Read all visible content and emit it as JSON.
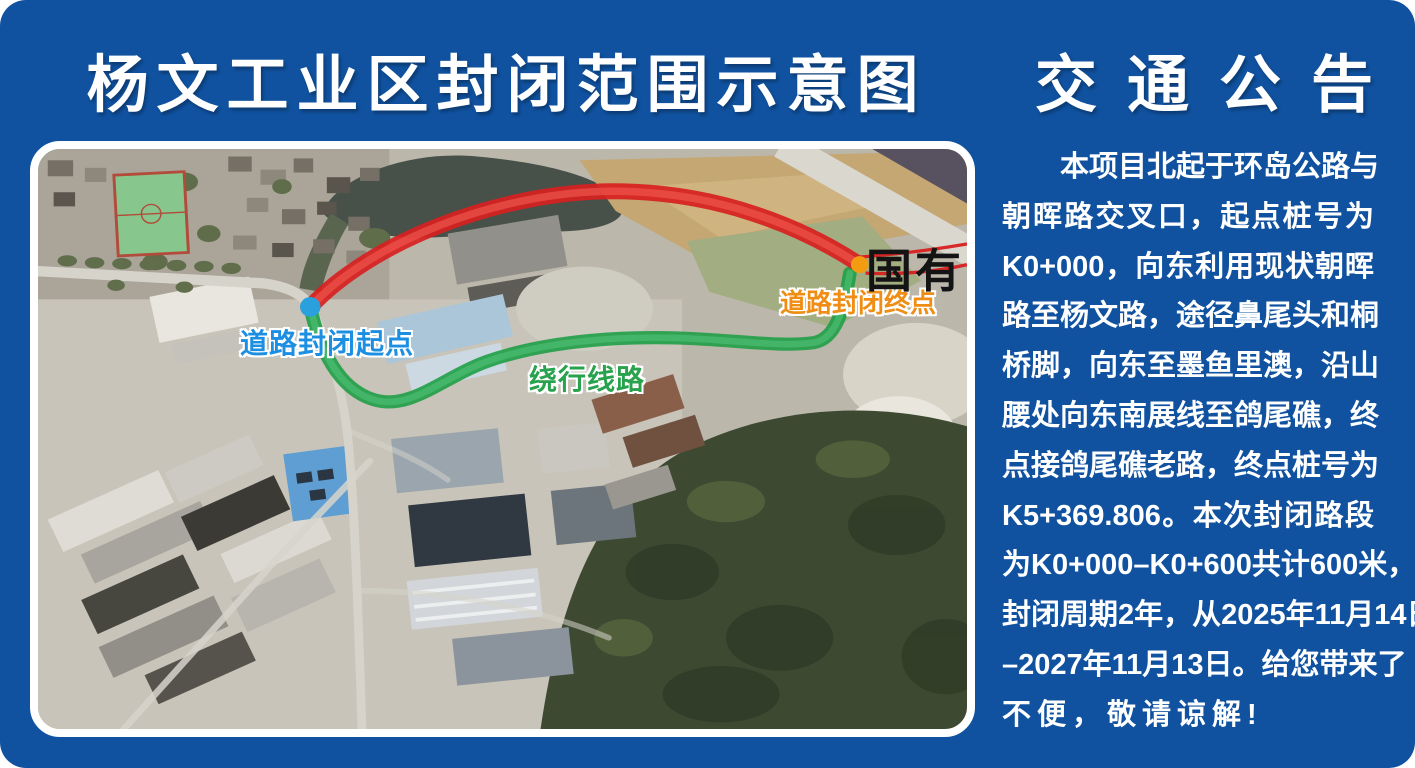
{
  "poster": {
    "bg_color": "#1052a0",
    "map_title": "杨文工业区封闭范围示意图",
    "notice_title": "交通公告"
  },
  "notice_lines": [
    "本项目北起于环岛公路与",
    "朝晖路交叉口，起点桩号为",
    "K0+000，向东利用现状朝晖",
    "路至杨文路，途径鼻尾头和桐",
    "桥脚，向东至墨鱼里澳，沿山",
    "腰处向东南展线至鸽尾礁，终",
    "点接鸽尾礁老路，终点桩号为",
    "K5+369.806。本次封闭路段",
    "为K0+000–K0+600共计600米，",
    "封闭周期2年，从2025年11月14日",
    "–2027年11月13日。给您带来了",
    "不便，敬请谅解!"
  ],
  "map": {
    "closure_start_label": "道路封闭起点",
    "closure_end_label": "道路封闭终点",
    "detour_label": "绕行线路",
    "terrain_label": "国有",
    "closed_route_color": "#d81f1f",
    "closed_route_inner_color": "#f15b52",
    "detour_route_color": "#1f9e47",
    "detour_route_inner_color": "#53c47b",
    "start_marker_color": "#2aa0dc",
    "end_marker_color": "#f39c12",
    "start_label_color": "#1d8fe2",
    "end_label_color": "#ef8d15",
    "detour_label_color": "#28a24c"
  }
}
